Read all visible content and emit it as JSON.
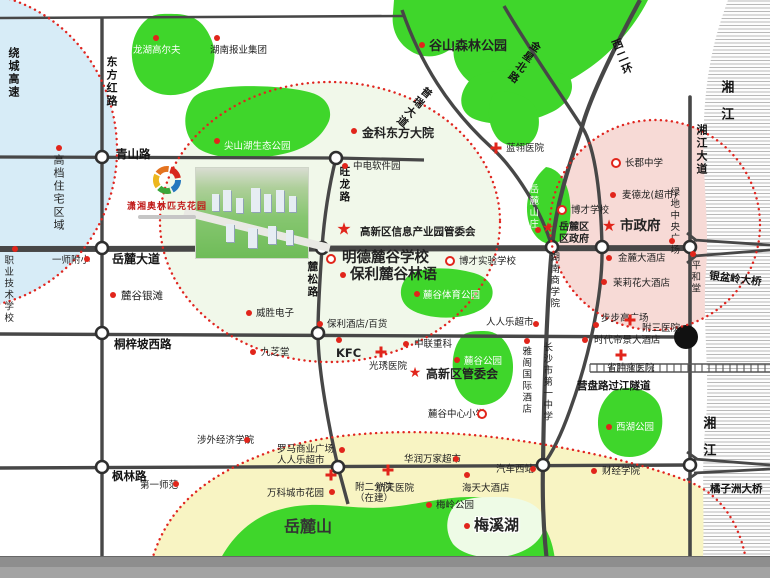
{
  "logo": {
    "name": "潇湘奥林匹克花园"
  },
  "map": {
    "colors": {
      "road": "#474747",
      "park": "#3fd62b",
      "dotted": "#e02620",
      "zone_blue": "#d7ecf7",
      "zone_pink": "#f7dad6",
      "zone_yellow": "#f8f4c3",
      "zone_project": "#f1f8ea"
    },
    "zones": [
      {
        "id": "northwest-residential",
        "cx": -35,
        "cy": 150,
        "rx": 152,
        "ry": 158,
        "fill": "#d7ecf7"
      },
      {
        "id": "project-radius",
        "cx": 330,
        "cy": 222,
        "rx": 170,
        "ry": 140,
        "fill": "#f1f8ea"
      },
      {
        "id": "city-center",
        "cx": 655,
        "cy": 225,
        "rx": 105,
        "ry": 105,
        "fill": "#f7dad6"
      },
      {
        "id": "meixihu-south",
        "d_fill": "M152,560 C168,505 208,474 272,451 C345,427 440,429 515,440 C585,450 652,466 692,483 C722,496 740,525 746,560 L746,578 L152,578 Z",
        "d_border": "M152,560 C168,505 208,474 272,451 C345,427 440,429 515,440 C585,450 652,466 692,483 C722,496 740,525 746,560",
        "fill": "#f8f4c3"
      }
    ],
    "parks": [
      {
        "id": "park-longhu-golf",
        "d": "M150,17 C133,28 127,52 136,74 C145,94 169,100 190,91 C211,82 219,60 212,41 C205,23 195,15 177,14 C166,14 158,13 150,17 Z"
      },
      {
        "id": "park-baoye",
        "d": "M197,95 C186,107 186,127 197,139 C209,151 233,153 246,143 C258,135 260,115 252,103 C241,91 209,85 197,95 Z"
      },
      {
        "id": "park-jianshanhu",
        "d": "M193,98 C181,114 183,137 199,149 C217,160 252,161 283,154 C307,149 322,137 329,121 C333,109 326,97 312,93 C288,85 207,81 193,98 Z"
      },
      {
        "id": "park-gushan-forest",
        "d": "M255,0 L648,0 C637,22 620,43 601,59 C584,73 561,87 539,93 C517,99 494,97 477,87 C461,78 451,62 454,46 C442,58 423,60 409,50 C397,42 391,28 393,13 L394,0 Z"
      },
      {
        "id": "park-gushan-lobe",
        "d": "M470,80 C458,94 458,110 472,118 C492,128 528,124 552,112 C568,104 576,90 570,78 C560,66 484,66 470,80 Z"
      },
      {
        "id": "park-west-strip",
        "d": "M493,95 C486,109 488,127 498,139 C506,147 520,149 530,143 C540,135 542,117 534,105 C526,94 500,87 493,95 Z"
      },
      {
        "id": "park-yuelu-villa",
        "d": "M546,167 C532,179 524,199 528,219 C532,237 544,247 556,243 C568,239 572,221 570,201 C568,183 560,169 546,167 Z"
      },
      {
        "id": "park-lugu-sports",
        "d": "M409,275 C398,285 398,301 410,309 C421,316 439,319 457,317 C473,315 488,309 492,297 C495,287 488,277 474,273 C450,266 420,267 409,275 Z"
      },
      {
        "id": "park-lugu",
        "d": "M463,335 C452,347 450,367 456,385 C462,401 476,409 492,403 C508,397 516,377 512,357 C508,341 498,331 484,331 C476,331 469,331 463,335 Z"
      },
      {
        "id": "park-westlake",
        "d": "M613,391 C598,403 594,423 602,441 C610,457 630,461 646,453 C660,445 666,425 660,407 C654,391 632,383 613,391 Z"
      },
      {
        "id": "yuelu-mountain",
        "d": "M212,578 C224,544 248,517 282,509 C320,499 352,511 390,507 C420,504 444,497 470,497 C498,497 522,504 538,519 C550,531 556,551 556,578 Z"
      },
      {
        "id": "meixi-lake",
        "fill": "#eefbe6",
        "d": "M456,504 C446,514 444,531 453,544 C463,556 489,561 512,555 C534,549 547,535 544,519 C541,505 523,497 500,497 C482,497 466,497 456,504 Z"
      }
    ],
    "river": {
      "d": "M728,0 L770,0 L770,578 L702,578 C706,520 700,470 706,420 C710,370 702,320 706,270 C710,220 701,170 704,120 C707,60 718,28 728,0 Z"
    },
    "roads": [
      {
        "n": "north-road",
        "d": "M0,18 L404,16",
        "w": 2.6
      },
      {
        "n": "qingshan-rd",
        "d": "M0,157 L336,158 L424,160",
        "w": 3.2
      },
      {
        "n": "yuelu-avenue",
        "d": "M0,249 L690,248",
        "w": 6
      },
      {
        "n": "tongzipo-west-rd",
        "d": "M0,334 L680,337",
        "w": 3.4
      },
      {
        "n": "fenglin-rd",
        "d": "M0,468 L690,465",
        "w": 3.4
      },
      {
        "n": "dongfanghong-rd",
        "d": "M102,18 L102,556",
        "w": 3.4
      },
      {
        "n": "xiangjiang-avenue",
        "d": "M690,97 L690,556",
        "w": 3.6,
        "cap": "round"
      },
      {
        "n": "wanglong-lusong-rd",
        "d": "M336,158 C328,190 324,220 322,248 C320,280 318,305 318,333 C318,372 330,432 338,467 L348,504",
        "w": 3.4
      },
      {
        "n": "west-2nd-ring",
        "d": "M640,0 C612,52 590,98 582,127 C568,168 556,205 552,247 C547,300 544,390 543,465 C542,505 544,542 549,578",
        "w": 4.2
      },
      {
        "n": "jinxing-north-rd",
        "d": "M504,6 C526,44 562,96 582,127 C596,148 601,200 602,247 C603,292 590,355 570,410 C560,438 550,456 543,465",
        "w": 3.4
      },
      {
        "n": "purui-avenue",
        "d": "M402,10 C420,62 448,108 492,148 C516,170 542,212 552,247",
        "w": 3.4
      }
    ],
    "junctions": [
      [
        102,
        157
      ],
      [
        336,
        158
      ],
      [
        102,
        248
      ],
      [
        322,
        248
      ],
      [
        552,
        247
      ],
      [
        602,
        247
      ],
      [
        690,
        247
      ],
      [
        102,
        333
      ],
      [
        318,
        333
      ],
      [
        102,
        467
      ],
      [
        338,
        467
      ],
      [
        543,
        465
      ],
      [
        690,
        465
      ]
    ],
    "tunnel": {
      "x1": 590,
      "x2": 770,
      "y": 368,
      "half": 4,
      "step": 7,
      "portal": [
        686,
        337
      ]
    },
    "bridges": [
      {
        "id": "yinpenling-bridge-symbol",
        "d": "M694,240 L770,245 M694,256 L770,250 M687,233 L697,241 M687,263 L697,255"
      },
      {
        "id": "juzizhou-bridge-symbol",
        "d": "M694,459 L770,465 M694,473 L770,469 M687,452 L697,459 M687,480 L697,473"
      }
    ],
    "road_labels": [
      {
        "t": "青山路",
        "x": 116,
        "y": 148,
        "fs": 11.5
      },
      {
        "t": "岳麓大道",
        "x": 112,
        "y": 252,
        "fs": 12
      },
      {
        "t": "桐梓坡西路",
        "x": 114,
        "y": 338,
        "fs": 11.5
      },
      {
        "t": "枫林路",
        "x": 112,
        "y": 470,
        "fs": 11.5
      },
      {
        "t": "东方红路",
        "x": 104,
        "y": 56,
        "fs": 11,
        "v": 1
      },
      {
        "t": "绕城高速",
        "x": 6,
        "y": 47,
        "fs": 11,
        "v": 1
      },
      {
        "t": "旺龙路",
        "x": 338,
        "y": 166,
        "fs": 10.5,
        "v": 1
      },
      {
        "t": "麓松路",
        "x": 306,
        "y": 261,
        "fs": 10.5,
        "v": 1
      },
      {
        "t": "湘江大道",
        "x": 694,
        "y": 124,
        "fs": 11,
        "v": 1
      },
      {
        "t": "西二环",
        "x": 608,
        "y": 42,
        "fs": 11,
        "v": 1,
        "rot": -22
      },
      {
        "t": "金星北路",
        "x": 533,
        "y": 38,
        "fs": 10.5,
        "v": 1,
        "rot": 35
      },
      {
        "t": "普瑞大道",
        "x": 425,
        "y": 84,
        "fs": 10.5,
        "v": 1,
        "rot": 40
      },
      {
        "t": "湘江",
        "x": 718,
        "y": 80,
        "fs": 13,
        "v": 1,
        "sp": 14
      },
      {
        "t": "湘江",
        "x": 700,
        "y": 416,
        "fs": 13,
        "v": 1,
        "sp": 14
      },
      {
        "t": "营盘路过江隧道",
        "x": 577,
        "y": 380,
        "fs": 10.5
      },
      {
        "t": "银盆岭大桥",
        "x": 710,
        "y": 270,
        "fs": 10.5,
        "rot": 7
      },
      {
        "t": "橘子洲大桥",
        "x": 710,
        "y": 483,
        "fs": 10.5
      }
    ],
    "pois": [
      {
        "t": "高档住宅区域",
        "x": 51,
        "y": 154,
        "v": 1,
        "fs": 11,
        "m": "dot",
        "mx": 59,
        "my": 148
      },
      {
        "t": "龙湖高尔夫",
        "x": 133,
        "y": 45,
        "c": "#fff",
        "fs": 9.5,
        "m": "dot",
        "mx": 156,
        "my": 38
      },
      {
        "t": "湖南报业集团",
        "x": 210,
        "y": 45,
        "fs": 9.5,
        "m": "dot",
        "mx": 217,
        "my": 38
      },
      {
        "t": "谷山森林公园",
        "x": 429,
        "y": 39,
        "b": 1,
        "fs": 13,
        "m": "dot",
        "mx": 422,
        "my": 45
      },
      {
        "t": "尖山湖生态公园",
        "x": 224,
        "y": 141,
        "c": "#fff",
        "fs": 9.5,
        "m": "dot",
        "mx": 217,
        "my": 141
      },
      {
        "t": "金科东方大院",
        "x": 362,
        "y": 126,
        "b": 1,
        "fs": 12,
        "m": "dot",
        "mx": 354,
        "my": 131
      },
      {
        "t": "蓝翎医院",
        "x": 506,
        "y": 143,
        "fs": 9.5,
        "m": "cross",
        "mx": 496,
        "my": 148
      },
      {
        "t": "中电软件园",
        "x": 353,
        "y": 161,
        "fs": 9.5,
        "m": "dot",
        "mx": 345,
        "my": 166
      },
      {
        "t": "长郡中学",
        "x": 625,
        "y": 158,
        "fs": 9.5,
        "m": "ring",
        "mx": 616,
        "my": 163
      },
      {
        "t": "麦德龙(超市)",
        "x": 622,
        "y": 190,
        "fs": 9.5,
        "m": "dot",
        "mx": 613,
        "my": 195
      },
      {
        "t": "博才学校",
        "x": 571,
        "y": 205,
        "fs": 9.5,
        "m": "ring",
        "mx": 562,
        "my": 210
      },
      {
        "t": "市政府",
        "x": 620,
        "y": 219,
        "b": 1,
        "fs": 13.5,
        "m": "star",
        "mx": 609,
        "my": 226,
        "ms": 16
      },
      {
        "lines": [
          "岳麓区",
          "区政府"
        ],
        "x": 559,
        "y": 222,
        "fs": 10,
        "b": 1,
        "m": "star",
        "mx": 548,
        "my": 228,
        "ms": 14
      },
      {
        "t": "绿地中央广场",
        "x": 668,
        "y": 187,
        "v": 1,
        "fs": 9.5,
        "m": "dot",
        "mx": 672,
        "my": 241
      },
      {
        "t": "平和堂",
        "x": 689,
        "y": 260,
        "v": 1,
        "fs": 9.5,
        "m": "dot",
        "mx": 693,
        "my": 254
      },
      {
        "t": "金麓大酒店",
        "x": 618,
        "y": 253,
        "fs": 9.5,
        "m": "dot",
        "mx": 609,
        "my": 258
      },
      {
        "t": "茉莉花大酒店",
        "x": 613,
        "y": 278,
        "fs": 9.5,
        "m": "dot",
        "mx": 604,
        "my": 282
      },
      {
        "t": "湖南商学院",
        "x": 548,
        "y": 252,
        "v": 1,
        "fs": 9.5
      },
      {
        "t": "岳麓山庄",
        "x": 527,
        "y": 184,
        "v": 1,
        "fs": 9.5,
        "c": "#fff",
        "m": "dot",
        "mx": 538,
        "my": 230
      },
      {
        "t": "博才实验学校",
        "x": 459,
        "y": 256,
        "fs": 9.5,
        "m": "ring",
        "mx": 450,
        "my": 261
      },
      {
        "t": "明德麓谷学校",
        "x": 342,
        "y": 250,
        "b": 1,
        "fs": 14.5,
        "m": "ring",
        "mx": 331,
        "my": 259
      },
      {
        "t": "保利麓谷林语",
        "x": 350,
        "y": 267,
        "b": 1,
        "fs": 14.5,
        "m": "dot",
        "mx": 343,
        "my": 275
      },
      {
        "t": "高新区信息产业园管委会",
        "x": 360,
        "y": 226,
        "b": 1,
        "fs": 10.5,
        "m": "star",
        "mx": 344,
        "my": 230,
        "ms": 17
      },
      {
        "t": "麓谷体育公园",
        "x": 423,
        "y": 290,
        "c": "#fff",
        "fs": 9.5,
        "m": "dot",
        "mx": 417,
        "my": 294
      },
      {
        "t": "威胜电子",
        "x": 256,
        "y": 308,
        "fs": 9.5,
        "m": "dot",
        "mx": 249,
        "my": 313
      },
      {
        "t": "保利酒店/百货",
        "x": 327,
        "y": 319,
        "fs": 9.5,
        "m": "dot",
        "mx": 320,
        "my": 324
      },
      {
        "t": "人人乐超市",
        "x": 486,
        "y": 317,
        "fs": 9.5,
        "m": "dot",
        "mx": 536,
        "my": 324
      },
      {
        "t": "麓谷银滩",
        "x": 121,
        "y": 290,
        "fs": 10.5,
        "m": "dot",
        "mx": 113,
        "my": 295
      },
      {
        "t": "九芝堂",
        "x": 261,
        "y": 347,
        "fs": 9.5,
        "m": "dot",
        "mx": 253,
        "my": 352
      },
      {
        "t": "KFC",
        "x": 336,
        "y": 347,
        "b": 1,
        "fs": 11.5,
        "m": "dot",
        "mx": 339,
        "my": 340
      },
      {
        "t": "中联重科",
        "x": 414,
        "y": 339,
        "fs": 9.5,
        "m": "dot",
        "mx": 406,
        "my": 344
      },
      {
        "t": "光琇医院",
        "x": 369,
        "y": 361,
        "fs": 9.5,
        "m": "cross",
        "mx": 381,
        "my": 352
      },
      {
        "t": "麓谷公园",
        "x": 464,
        "y": 356,
        "c": "#fff",
        "fs": 9.5,
        "m": "dot",
        "mx": 457,
        "my": 360
      },
      {
        "t": "高新区管委会",
        "x": 426,
        "y": 367,
        "b": 1,
        "fs": 12,
        "m": "star",
        "mx": 415,
        "my": 373,
        "ms": 14
      },
      {
        "t": "麓谷中心小学",
        "x": 428,
        "y": 409,
        "fs": 9.5,
        "m": "ring",
        "mx": 482,
        "my": 414
      },
      {
        "t": "步步高广场",
        "x": 601,
        "y": 313,
        "fs": 9.5,
        "m": "dot",
        "mx": 596,
        "my": 325
      },
      {
        "t": "附三医院",
        "x": 642,
        "y": 323,
        "fs": 9.5,
        "m": "cross",
        "mx": 630,
        "my": 320
      },
      {
        "t": "时代帝景大酒店",
        "x": 594,
        "y": 335,
        "fs": 9.5,
        "m": "dot",
        "mx": 585,
        "my": 340
      },
      {
        "t": "省肿瘤医院",
        "x": 607,
        "y": 363,
        "fs": 9.5,
        "m": "cross",
        "mx": 621,
        "my": 355
      },
      {
        "t": "雅阁国际酒店",
        "x": 520,
        "y": 346,
        "v": 1,
        "fs": 9.5,
        "m": "dot",
        "mx": 527,
        "my": 341
      },
      {
        "t": "长沙市第一中学",
        "x": 541,
        "y": 342,
        "v": 1,
        "fs": 9.5
      },
      {
        "t": "西湖公园",
        "x": 616,
        "y": 422,
        "c": "#fff",
        "fs": 9.5,
        "m": "dot",
        "mx": 609,
        "my": 427
      },
      {
        "t": "涉外经济学院",
        "x": 197,
        "y": 435,
        "fs": 9.5,
        "m": "dot",
        "mx": 247,
        "my": 440
      },
      {
        "t": "第一师范",
        "x": 140,
        "y": 480,
        "fs": 9.5,
        "m": "dot",
        "mx": 176,
        "my": 484
      },
      {
        "lines": [
          "罗马商业广场",
          "人人乐超市"
        ],
        "x": 277,
        "y": 444,
        "fs": 9.5,
        "m": "dot",
        "mx": 342,
        "my": 450
      },
      {
        "t": "万科城市花园",
        "x": 267,
        "y": 488,
        "fs": 9.5,
        "m": "dot",
        "mx": 332,
        "my": 492
      },
      {
        "lines": [
          "附二分院",
          "（在建）"
        ],
        "x": 355,
        "y": 482,
        "fs": 9.5,
        "m": "cross",
        "mx": 331,
        "my": 475
      },
      {
        "t": "航天医院",
        "x": 376,
        "y": 483,
        "fs": 9.5,
        "m": "cross",
        "mx": 388,
        "my": 470
      },
      {
        "t": "华润万家超市",
        "x": 404,
        "y": 454,
        "fs": 9.5,
        "m": "dot",
        "mx": 456,
        "my": 459
      },
      {
        "t": "汽车西站",
        "x": 496,
        "y": 464,
        "fs": 9.5,
        "m": "dot",
        "mx": 533,
        "my": 469
      },
      {
        "t": "海天大酒店",
        "x": 462,
        "y": 483,
        "fs": 9.5,
        "m": "dot",
        "mx": 467,
        "my": 475
      },
      {
        "t": "梅岭公园",
        "x": 436,
        "y": 500,
        "fs": 9.5,
        "m": "dot",
        "mx": 429,
        "my": 505
      },
      {
        "t": "岳麓山",
        "x": 284,
        "y": 518,
        "b": 1,
        "fs": 16,
        "c": "#333"
      },
      {
        "t": "梅溪湖",
        "x": 474,
        "y": 517,
        "b": 1,
        "fs": 15,
        "halo": 1,
        "m": "dot",
        "mx": 467,
        "my": 526
      },
      {
        "t": "财经学院",
        "x": 602,
        "y": 466,
        "fs": 9.5,
        "m": "dot",
        "mx": 594,
        "my": 471
      },
      {
        "t": "一师附小",
        "x": 52,
        "y": 255,
        "fs": 9.5,
        "m": "dot",
        "mx": 87,
        "my": 259
      },
      {
        "t": "职业技术学校",
        "x": 2,
        "y": 255,
        "v": 1,
        "fs": 9.5,
        "m": "dot",
        "mx": 15,
        "my": 249
      }
    ]
  }
}
